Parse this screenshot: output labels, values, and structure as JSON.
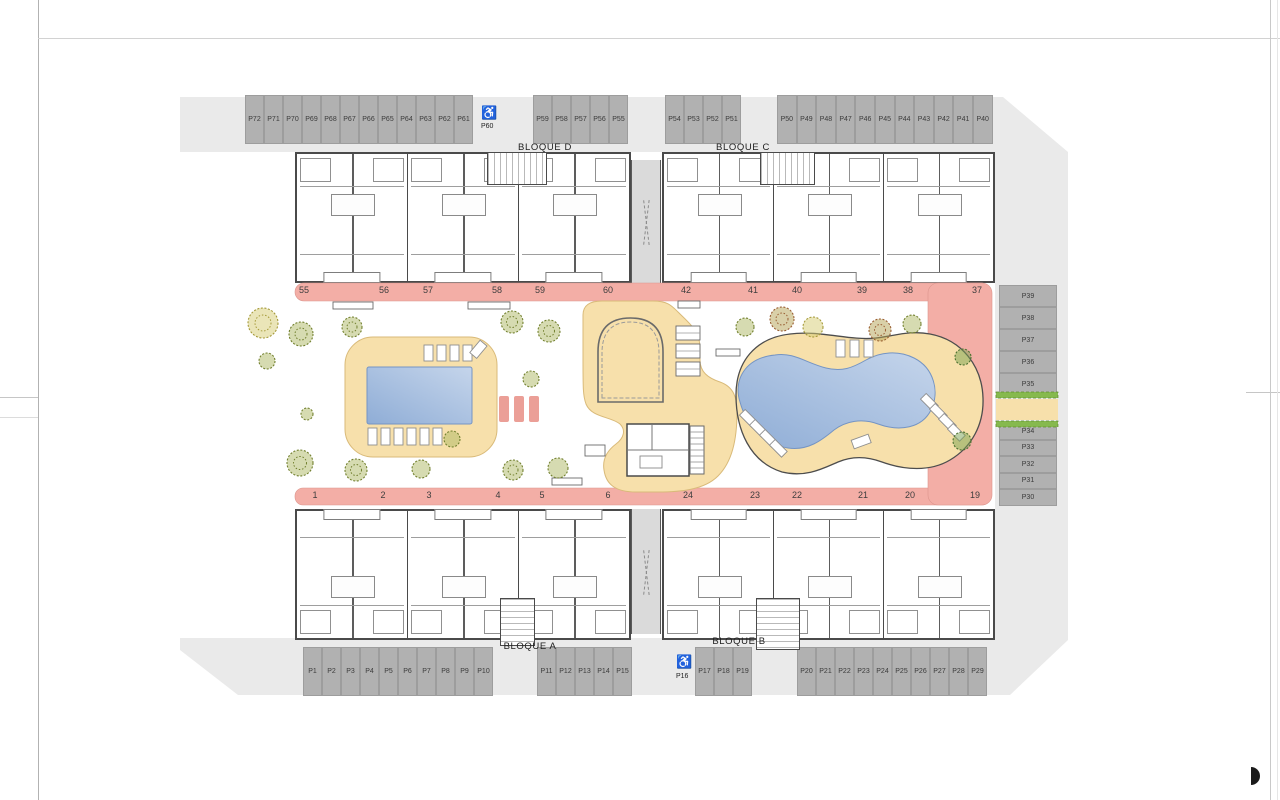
{
  "blocks": {
    "d": "BLOQUE D",
    "c": "BLOQUE C",
    "a": "BLOQUE A",
    "b": "BLOQUE B"
  },
  "icons": {
    "handicap": "♿"
  },
  "parking": {
    "top_left": [
      "P72",
      "P71",
      "P70",
      "P69",
      "P68",
      "P67",
      "P66",
      "P65",
      "P64",
      "P63",
      "P62",
      "P61"
    ],
    "top_left_handicap": "P60",
    "top_mid": [
      "P59",
      "P58",
      "P57",
      "P56",
      "P55"
    ],
    "top_right_inner": [
      "P54",
      "P53",
      "P52",
      "P51"
    ],
    "top_right": [
      "P50",
      "P49",
      "P48",
      "P47",
      "P46",
      "P45",
      "P44",
      "P43",
      "P42",
      "P41",
      "P40"
    ],
    "right_upper": [
      "P39",
      "P38",
      "P37",
      "P36",
      "P35"
    ],
    "right_lower": [
      "P34",
      "P33",
      "P32",
      "P31",
      "P30"
    ],
    "bottom_left": [
      "P1",
      "P2",
      "P3",
      "P4",
      "P5",
      "P6",
      "P7",
      "P8",
      "P9",
      "P10"
    ],
    "bottom_mid": [
      "P11",
      "P12",
      "P13",
      "P14",
      "P15"
    ],
    "bottom_handicap": "P16",
    "bottom_mid2": [
      "P17",
      "P18",
      "P19"
    ],
    "bottom_right": [
      "P20",
      "P21",
      "P22",
      "P23",
      "P24",
      "P25",
      "P26",
      "P27",
      "P28",
      "P29"
    ]
  },
  "units": {
    "top_left": [
      "55",
      "56",
      "57",
      "58",
      "59",
      "60"
    ],
    "top_right": [
      "42",
      "41",
      "40",
      "39",
      "38",
      "37"
    ],
    "bottom_left": [
      "1",
      "2",
      "3",
      "4",
      "5",
      "6"
    ],
    "bottom_right": [
      "24",
      "23",
      "22",
      "21",
      "20",
      "19"
    ]
  },
  "colors": {
    "site": "#eaeaea",
    "stall": "#b1b1b1",
    "walkway": "#f3aea6",
    "deck": "#f7e0ab",
    "pool": "#9db9dd"
  }
}
